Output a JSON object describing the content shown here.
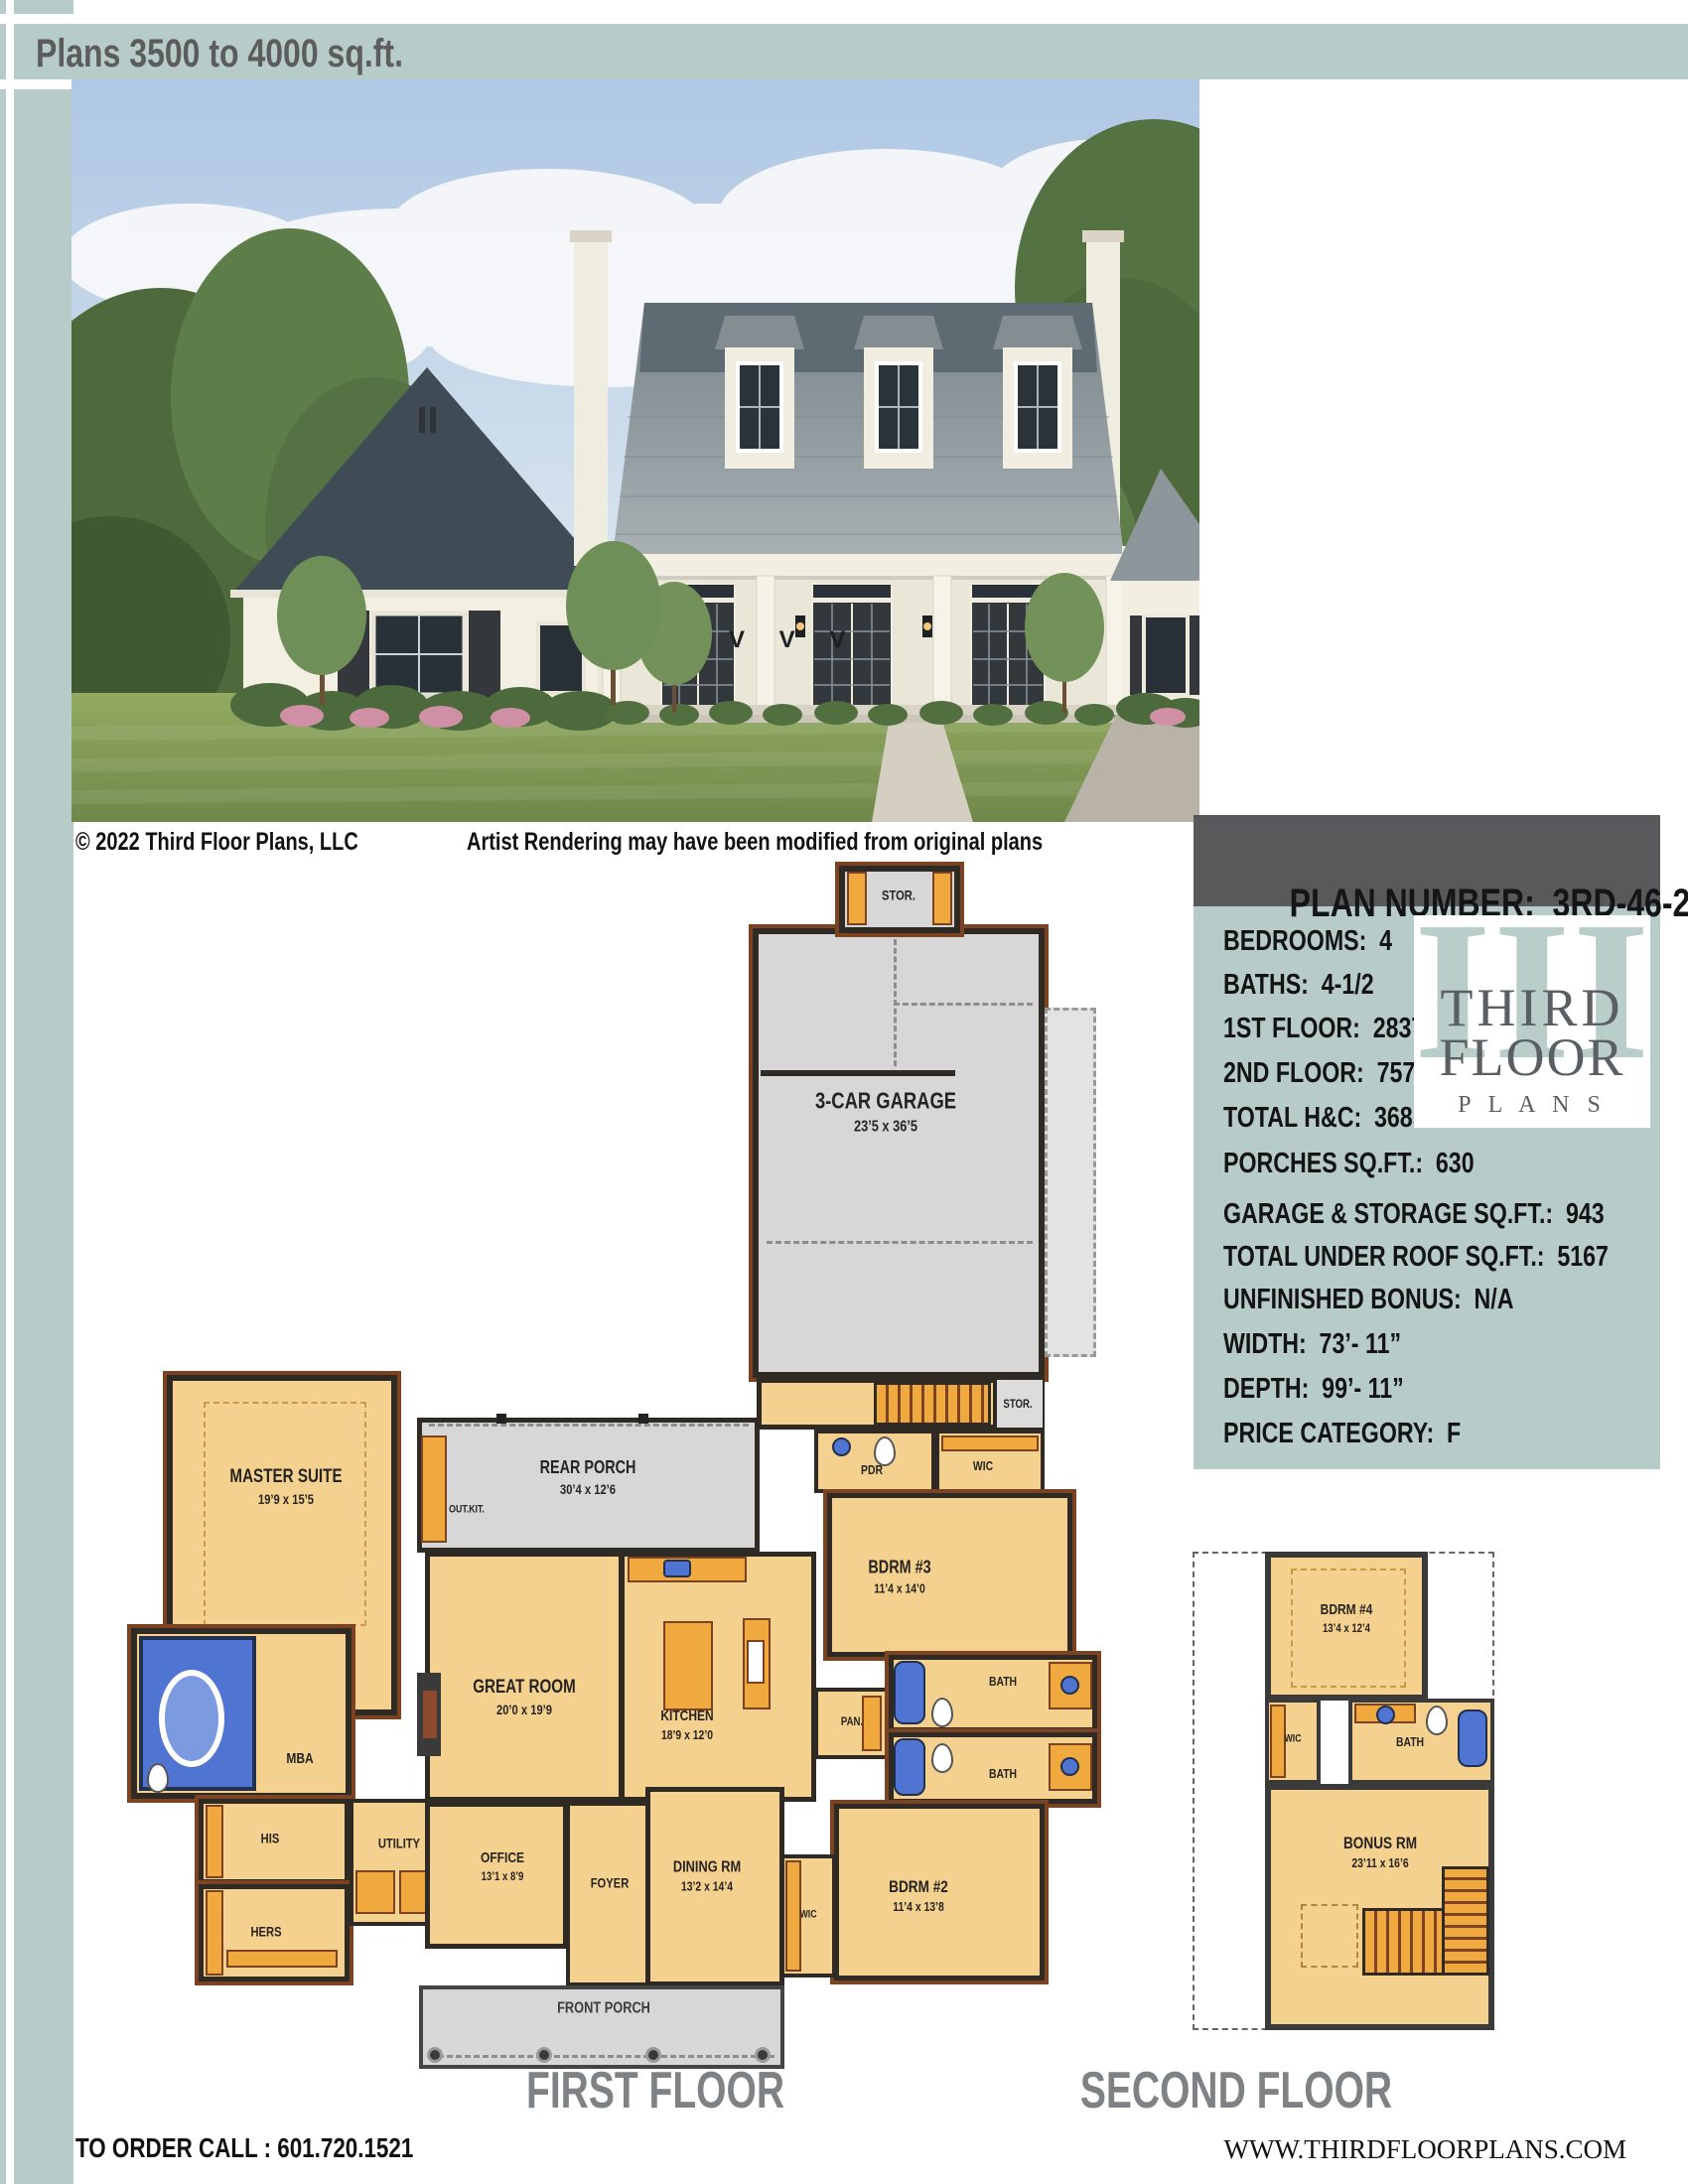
{
  "header": {
    "title": "Plans 3500 to 4000 sq.ft."
  },
  "photo": {
    "credit": "© 2022 Third Floor Plans, LLC",
    "note": "Artist Rendering may have been modified from original plans",
    "watermark": "V V V"
  },
  "panel": {
    "title": "PLAN NUMBER:  3RD-46-22",
    "stats": [
      {
        "label": "BEDROOMS:",
        "value": "4"
      },
      {
        "label": "BATHS:",
        "value": "4-1/2"
      },
      {
        "label": "1ST FLOOR:",
        "value": "2837"
      },
      {
        "label": "2ND FLOOR:",
        "value": "757"
      },
      {
        "label": "TOTAL H&C:",
        "value": "3685"
      },
      {
        "label": "PORCHES SQ.FT.:",
        "value": "630"
      },
      {
        "label": "GARAGE & STORAGE SQ.FT.:",
        "value": "943"
      },
      {
        "label": "TOTAL UNDER ROOF SQ.FT.:",
        "value": "5167"
      },
      {
        "label": "UNFINISHED BONUS:",
        "value": "N/A"
      },
      {
        "label": "WIDTH:",
        "value": "73’- 11”"
      },
      {
        "label": "DEPTH:",
        "value": "99’- 11”"
      },
      {
        "label": "PRICE CATEGORY:",
        "value": "F"
      }
    ],
    "logo": {
      "numeral": "III",
      "line1": "THIRD",
      "line2": "FLOOR",
      "line3": "P L A N S"
    }
  },
  "first_floor": {
    "caption": "FIRST FLOOR",
    "rooms": {
      "stor_top": {
        "name": "STOR."
      },
      "garage": {
        "name": "3-CAR GARAGE",
        "dims": "23’5 x 36’5"
      },
      "stor_stairs": {
        "name": "STOR."
      },
      "rear_porch": {
        "name": "REAR PORCH",
        "dims": "30’4 x 12’6"
      },
      "out_kit": {
        "name": "OUT.KIT."
      },
      "master": {
        "name": "MASTER SUITE",
        "dims": "19’9 x 15’5"
      },
      "mba": {
        "name": "MBA"
      },
      "his": {
        "name": "HIS"
      },
      "hers": {
        "name": "HERS"
      },
      "utility": {
        "name": "UTILITY"
      },
      "great": {
        "name": "GREAT ROOM",
        "dims": "20’0 x 19’9"
      },
      "kitchen": {
        "name": "KITCHEN",
        "dims": "18’9 x 12’0"
      },
      "pan": {
        "name": "PAN."
      },
      "pdr": {
        "name": "PDR"
      },
      "wic": {
        "name": "WIC"
      },
      "bdrm3": {
        "name": "BDRM #3",
        "dims": "11’4 x 14’0"
      },
      "bath3": {
        "name": "BATH"
      },
      "bath2": {
        "name": "BATH"
      },
      "bdrm2": {
        "name": "BDRM #2",
        "dims": "11’4 x 13’8"
      },
      "wic2": {
        "name": "WIC"
      },
      "office": {
        "name": "OFFICE",
        "dims": "13’1 x 8’9"
      },
      "foyer": {
        "name": "FOYER"
      },
      "dining": {
        "name": "DINING RM",
        "dims": "13’2 x 14’4"
      },
      "front_porch": {
        "name": "FRONT PORCH"
      }
    }
  },
  "second_floor": {
    "caption": "SECOND FLOOR",
    "rooms": {
      "bdrm4": {
        "name": "BDRM #4",
        "dims": "13’4 x 12’4"
      },
      "wic": {
        "name": "WIC"
      },
      "bath": {
        "name": "BATH"
      },
      "bonus": {
        "name": "BONUS RM",
        "dims": "23’11 x 16’6"
      }
    }
  },
  "footer": {
    "order": "TO ORDER CALL : 601.720.1521",
    "website": "WWW.THIRDFLOORPLANS.COM"
  }
}
